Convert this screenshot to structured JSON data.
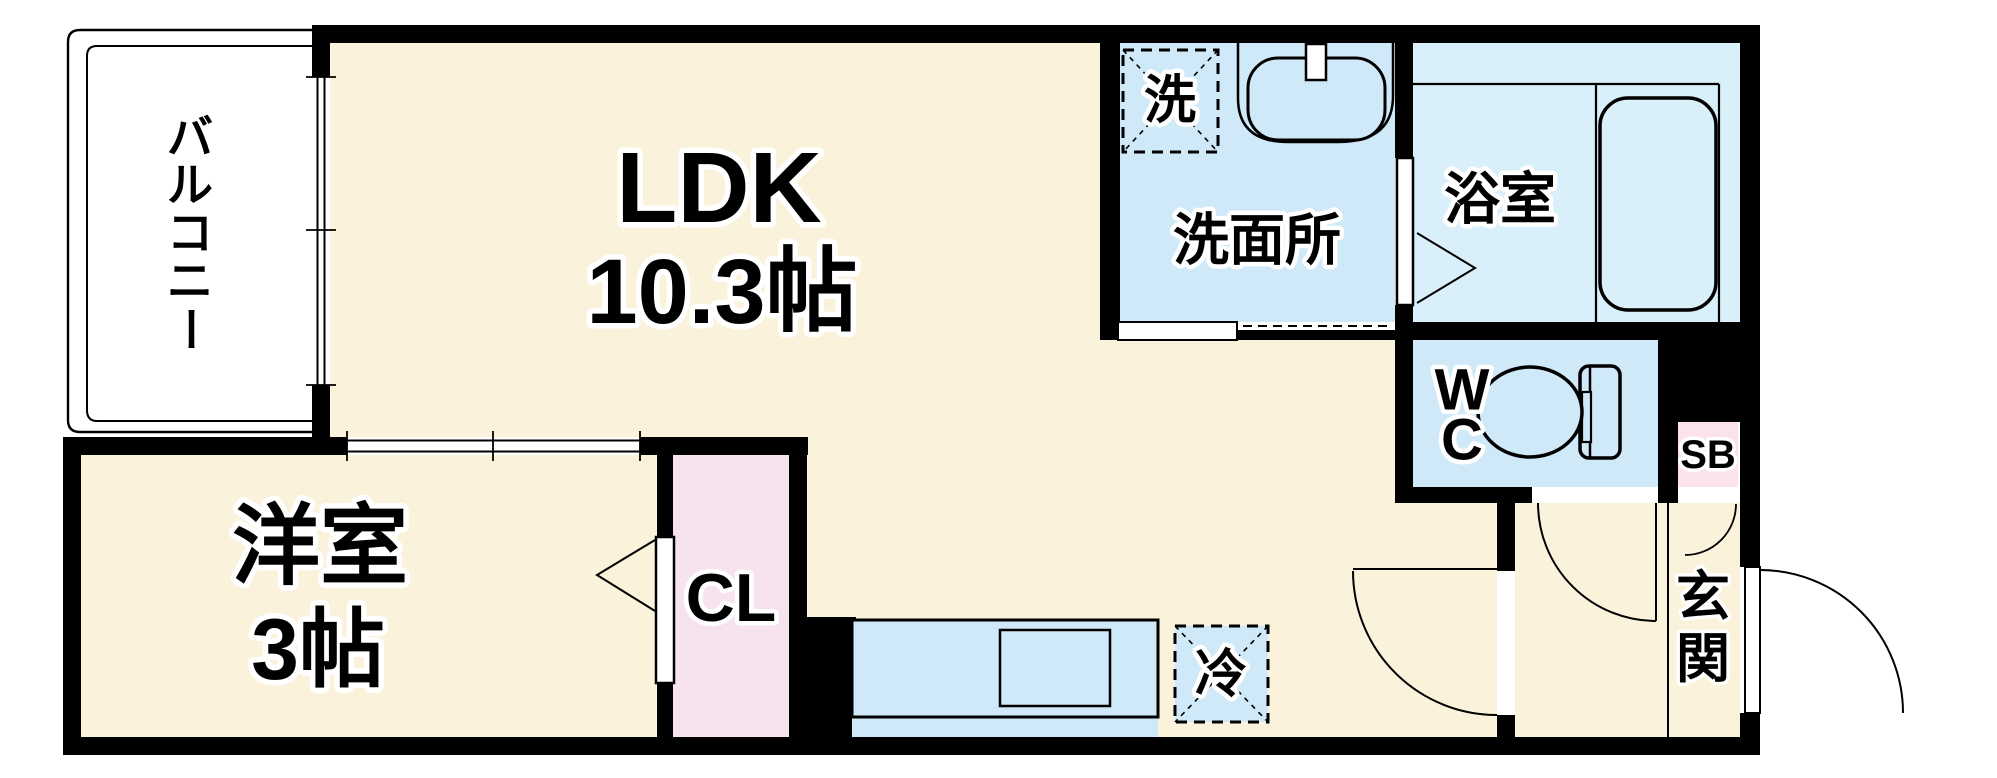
{
  "title": "apartment-floor-plan",
  "colors": {
    "wall": "#000000",
    "room_cream": "#FBF2DC",
    "water_blue": "#CFE9F8",
    "bath_blue": "#D9EFFA",
    "closet_pink": "#F7E3F0",
    "shoebox_pink": "#FBE3EE",
    "background": "#FFFFFF"
  },
  "rooms": {
    "balcony": {
      "label": "バルコニー",
      "chars": [
        "バ",
        "ル",
        "コ",
        "ニ",
        "ー"
      ]
    },
    "ldk": {
      "label": "LDK",
      "area": "10.3帖"
    },
    "washroom": {
      "label": "洗面所"
    },
    "washer": {
      "label": "洗"
    },
    "bathroom": {
      "label": "浴室"
    },
    "wc": {
      "label": "WC",
      "chars": [
        "W",
        "C"
      ]
    },
    "shoe_box": {
      "label": "SB"
    },
    "entrance": {
      "label": "玄関",
      "chars": [
        "玄",
        "関"
      ]
    },
    "western_room": {
      "label": "洋室",
      "area": "3帖"
    },
    "closet": {
      "label": "CL"
    },
    "refrigerator": {
      "label": "冷"
    }
  }
}
